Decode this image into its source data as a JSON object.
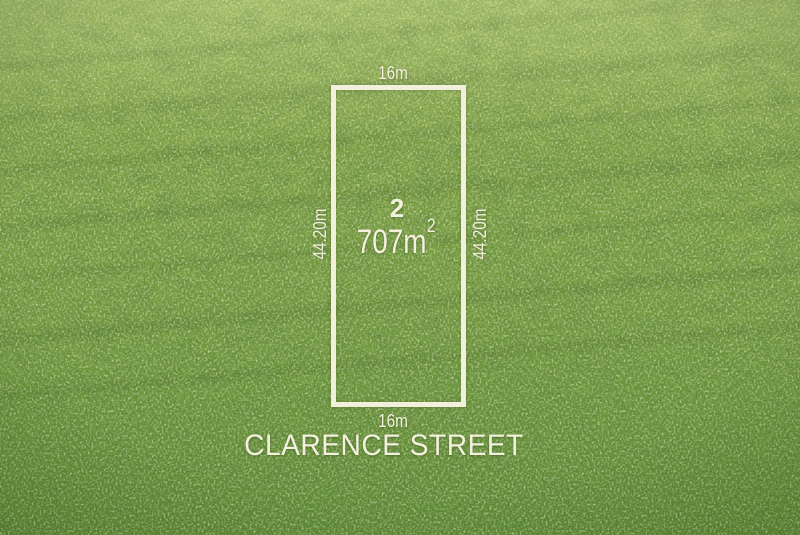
{
  "lot": {
    "number": "2",
    "area_value": "707m",
    "area_exponent": "2",
    "frontage_top": "16m",
    "frontage_bottom": "16m",
    "depth_left": "44.20m",
    "depth_right": "44.20m"
  },
  "street": {
    "name": "CLARENCE STREET"
  },
  "colors": {
    "boundary": "#f2efdd",
    "label": "#f3f0de",
    "grassTop": "#9cb95e",
    "grassUpper": "#8aa94c",
    "grassMid": "#7aa144",
    "grassBottom": "#5c8a33"
  }
}
